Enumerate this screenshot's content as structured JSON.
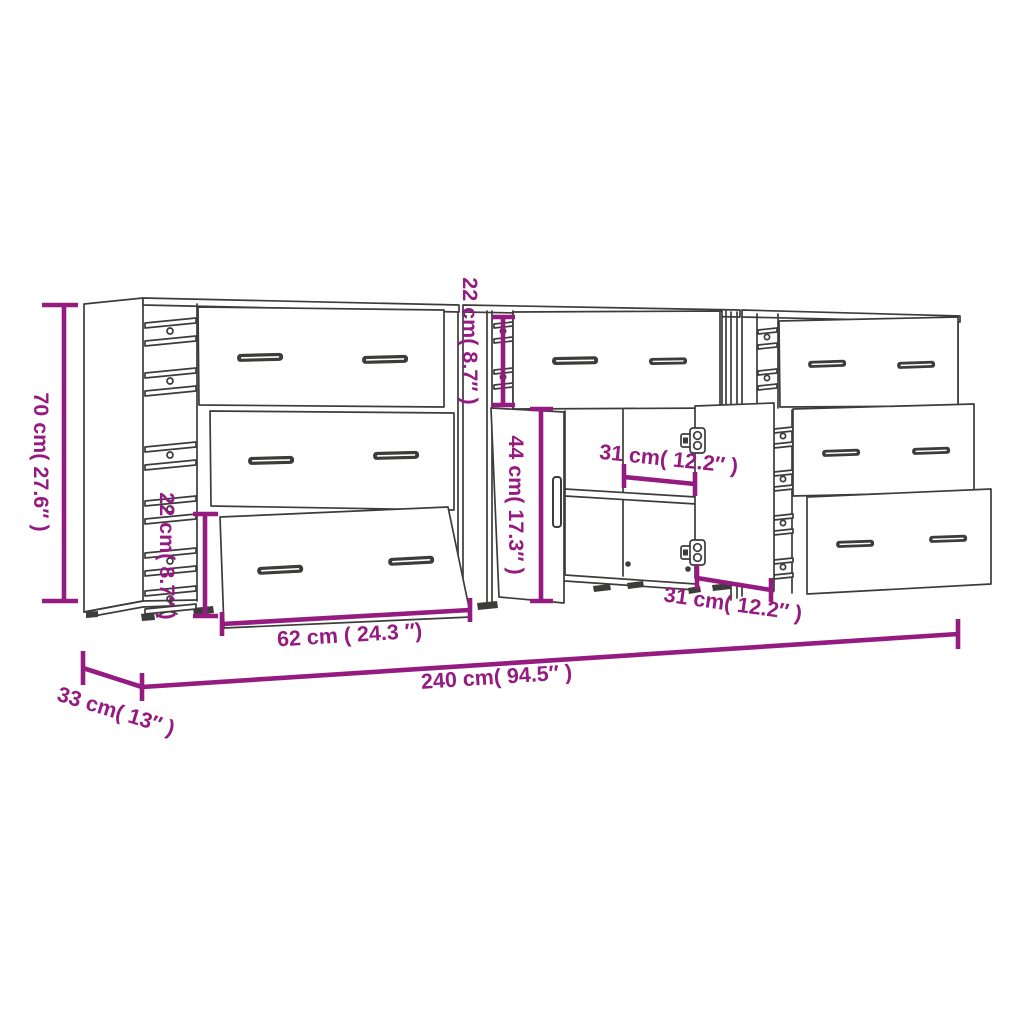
{
  "diagram": {
    "description": "Line drawing of three sideboard cabinets with open drawers and doors, annotated with dimensions",
    "colors": {
      "dimension_annotation": "#951b81",
      "line_art": "#3c3c3b",
      "background": "#ffffff"
    },
    "labels": {
      "overall_height": "70 cm( 27.6″ )",
      "left_drawer_height": "22 cm( 8.7″ )",
      "middle_top_drawer_height": "22 cm( 8.7″ )",
      "door_height": "44 cm( 17.3″ )",
      "door_width_upper": "31 cm( 12.2″ )",
      "door_width_lower": "31 cm( 12.2″ )",
      "drawer_width": "62 cm  ( 24.3  ″)",
      "overall_width": "240 cm( 94.5″ )",
      "depth": "33 cm( 13″ )"
    }
  }
}
